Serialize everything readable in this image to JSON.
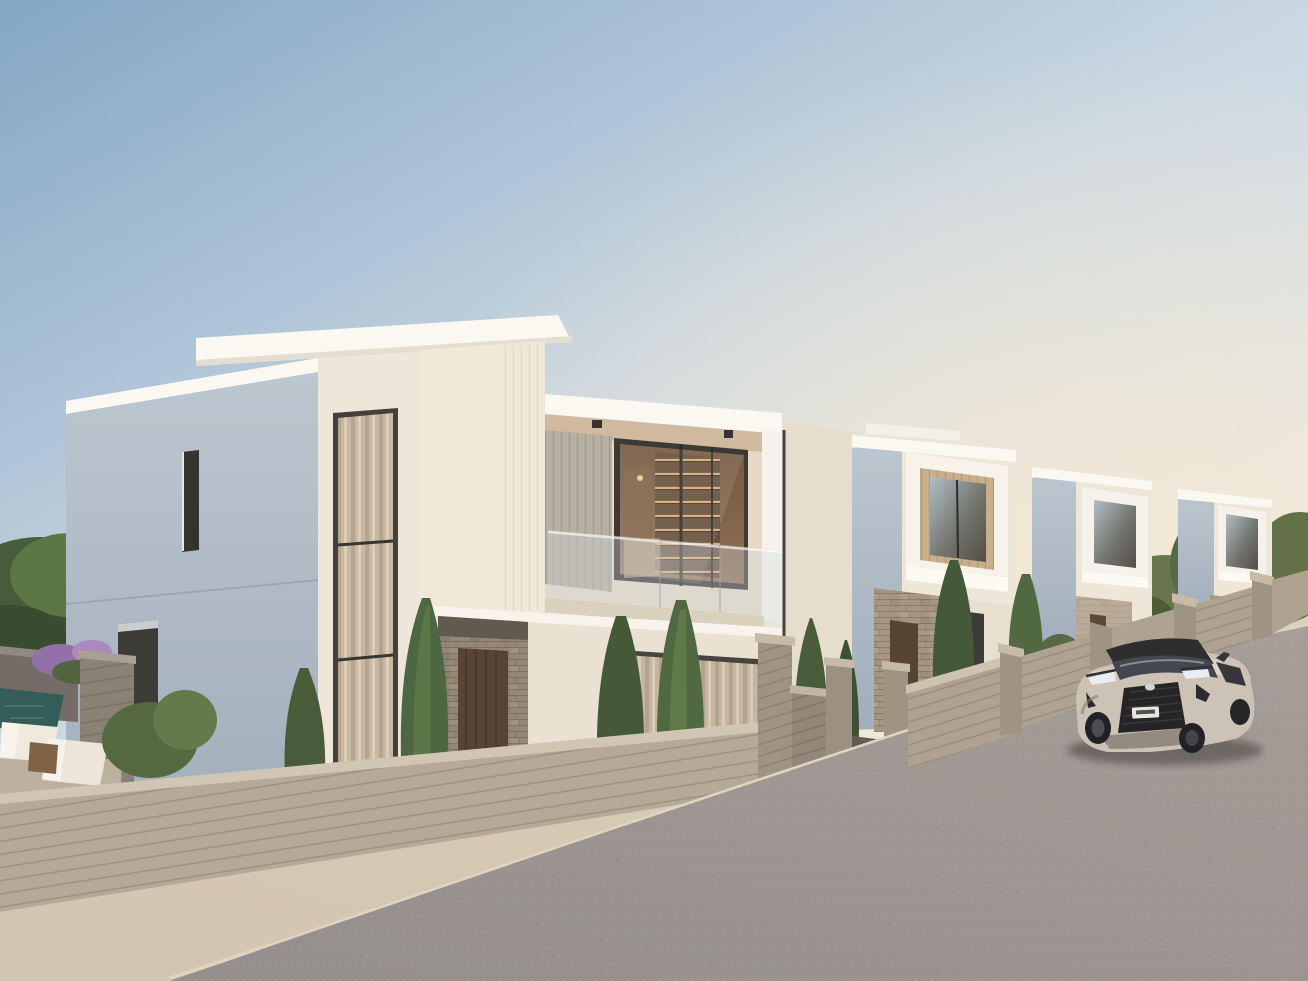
{
  "scene": {
    "type": "architectural-exterior-render",
    "description": "Sunset 3D rendering of a row of modern white cubic villas along a rising street, board-formed concrete garden walls, cypress trees, a pool garden on the left, and a champagne SUV parked on the asphalt road at the right.",
    "objects": [
      "sky",
      "horizon-glow",
      "villa-1-main",
      "villa-1-balcony",
      "villa-1-interior-shelving",
      "villa-2",
      "villa-3",
      "villa-4",
      "perimeter-wall",
      "driveway-gate",
      "street-fence",
      "sidewalk",
      "curb",
      "road",
      "suv-car",
      "pool",
      "sun-loungers",
      "cypress-trees",
      "garden-bushes",
      "purple-flowers",
      "stone-cladding",
      "wood-entry-doors",
      "curtained-windows"
    ],
    "palette": {
      "sky_top": "#7ea4c4",
      "sky_mid": "#c9d8e4",
      "sky_low": "#f4f2ec",
      "horizon_glow": "#f8e9cf",
      "facade_white": "#fbf9f3",
      "facade_sun": "#eee6d8",
      "facade_shadow": "#a9b6c3",
      "stone": "#a3937d",
      "wood_door": "#4e3b2a",
      "wood_slat": "#c6ad88",
      "wall_concrete": "#b3a694",
      "wall_concrete_dark": "#8e8477",
      "sidewalk": "#cfc3ae",
      "curb": "#ded3bf",
      "road": "#908b8b",
      "tree_dark": "#3c5230",
      "tree_light": "#5a7743",
      "flower_purple": "#8f6aa8",
      "flower_pink": "#c97fae",
      "pool_water": "#2a5553",
      "car_body": "#cac0b5",
      "car_roof": "#232327",
      "glass_dark": "#31302d",
      "interior_warm": "#c89a6b"
    },
    "car": {
      "kind": "compact luxury SUV",
      "color_name": "champagne silver with black roof",
      "position": "parked on the road, facing viewer",
      "license_plate_legible": false
    },
    "counts": {
      "villas_visible": 4,
      "cypress_trees_foreground": 7,
      "sun_loungers": 2
    }
  }
}
